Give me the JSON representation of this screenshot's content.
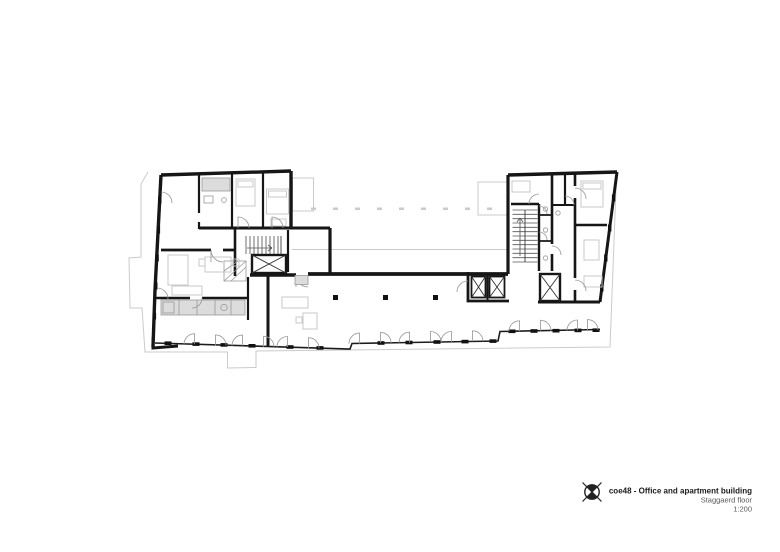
{
  "title_block": {
    "project": "coe48 - Office and apartment building",
    "floor": "Staggaerd floor",
    "scale": "1:200"
  },
  "icons": {
    "compass": "north-compass-icon"
  },
  "colors": {
    "wall": "#161616",
    "thin_line": "#3a3a3a",
    "furniture": "#c6c6c6",
    "site_outline": "#cbcbcb",
    "light_fill": "#dcdcdc",
    "text_primary": "#1a1a1a",
    "text_secondary": "#5a5a5a",
    "background": "#ffffff"
  }
}
